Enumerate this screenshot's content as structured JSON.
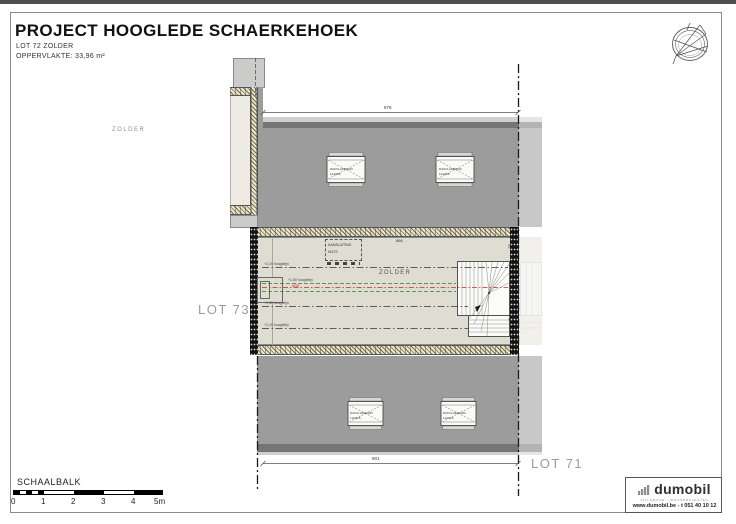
{
  "header": {
    "title": "PROJECT HOOGLEDE SCHAERKEHOEK",
    "subtitle": "LOT 72 ZOLDER",
    "area": "OPPERVLAKTE: 33,96 m²"
  },
  "plan": {
    "zone_label_left": "ZOLDER",
    "room_label": "ZOLDER",
    "lot_left": "LOT 73",
    "lot_right": "LOT 71",
    "dim_top": "876",
    "dim_bottom": "901",
    "dim_interior": "866",
    "dim_wall_top": "82",
    "dim_wall_bottom": "97",
    "nok_label": "NOK",
    "height_lines": {
      "l1": "+2,20 hoogtelijn",
      "l2": "+1,50 hoogtelijn",
      "l3": "+1,50 hoogtelijn",
      "l4": "+2,20 hoogtelijn"
    },
    "tech_box": {
      "line1": "AANSLUITING",
      "line2": "NUTS"
    },
    "skylight": {
      "line1": "DAKVLAKRAAM",
      "line2": "114/118"
    }
  },
  "scalebar": {
    "title": "SCHAALBALK",
    "ticks": [
      "0",
      "1",
      "2",
      "3",
      "4",
      "5m"
    ]
  },
  "titleblock": {
    "brand": "dumobil",
    "tagline": "VILLABOUW - WOONPROJECTEN",
    "contact": "www.dumobil.be - t 051 40 10 12"
  },
  "colors": {
    "roof": "#9c9c9c",
    "roof_dark": "#757575",
    "room": "#dfdcd2",
    "hatch_band": "#e9e5cc",
    "ridge_red": "#c62828",
    "line_green": "#2f8032",
    "lot_label_gray": "#9b9b9b"
  }
}
